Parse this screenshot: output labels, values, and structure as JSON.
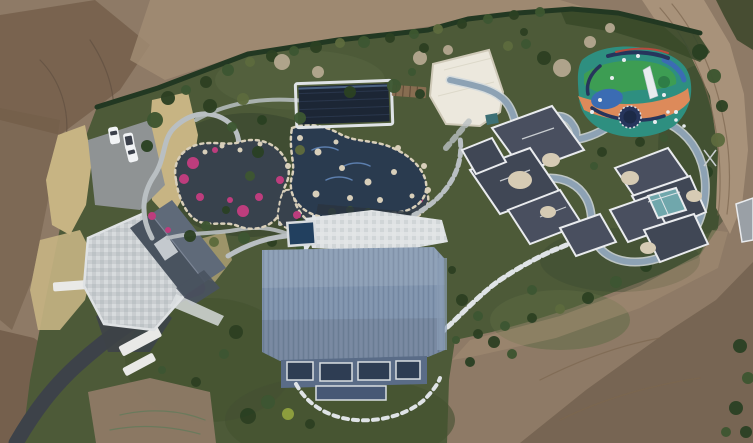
{
  "image": {
    "kind": "aerial-drone-photograph",
    "subject": "Top-down drone view of a private estate: landscaped ornamental garden with ponds and rockery pools, a dark louvred pool pavilion, a large steel-blue standing-seam roof house, two dark hip-roof villas with white parapets, a flat white pavilion, a colourful painted playground with trampoline and slide, a winding blue track, a parking pad with three white cars, an asphalt driveway, all surrounded by graded bare earth and a dirt road",
    "width_px": 753,
    "height_px": 443
  },
  "palette": {
    "dirt_base": "#8e7a66",
    "dirt_dark": "#715d4a",
    "dirt_light": "#a38d74",
    "dirt_shadow": "#5f4f3e",
    "road_dirt": "#a8927a",
    "rut": "#7c6750",
    "scrub_dark": "#474d31",
    "brush_dark": "#3a4a2b",
    "green_base": "#4d5a39",
    "lawn_dark": "#42502f",
    "lawn_light": "#5b6a42",
    "bed_dark": "#3a482c",
    "hedge": "#233720",
    "tree_dark": "#2c4124",
    "tree_mid": "#3d5630",
    "tree_olive": "#5d6b3d",
    "tree_pale": "#b3a78f",
    "tree_yellow": "#8fa03f",
    "reed": "#c7b483",
    "water_pond": "#39424d",
    "water_pool": "#2c3a50",
    "wave_blue": "#5b7fae",
    "rock_cream": "#d8cfba",
    "flower_pink": "#bd3c7d",
    "path_light": "#b9bfc2",
    "paver_white": "#dfe3e6",
    "track": "#8da2b4",
    "track_edge": "#d2d9dd",
    "pavilion": "#1e2836",
    "pergola": "#8a6f52",
    "white_roof": "#ece8dd",
    "white_roof_edge": "#cfc9b8",
    "equip_teal": "#3e6f74",
    "roof_main": "#7e92ac",
    "roof_side": "#8b9eb6",
    "facade": "#5a6c87",
    "window_dark": "#2e3c52",
    "glass_low": "#465974",
    "frame_white": "#d9dee2",
    "roof_villa": "#49505e",
    "roof_villa_dark": "#3f4654",
    "roof_trim": "#e9ebee",
    "roof_cream": "#d6cbb4",
    "glass_teal": "#6fa7ac",
    "roof_left": "#49525f",
    "roof_left_light": "#5f6a79",
    "terrace": "#c9cdd0",
    "terrace_light": "#dfe2e4",
    "shadow_band": "#2c3640",
    "asphalt": "#3e4348",
    "parking": "#8f9394",
    "car_white": "#f1f3f5",
    "car_glass": "#3a414b",
    "wall_white": "#e9e9e7",
    "spa_water": "#24405e",
    "play_teal": "#2e8f80",
    "play_green": "#3f9e4f",
    "play_orange": "#dd8a5a",
    "play_blue": "#3b6cb3",
    "play_navy": "#27355c",
    "play_red": "#b84a3c",
    "play_dome": "#2e7d46",
    "slide_white": "#e8ecef",
    "small_roof": "#9aa0a6",
    "pylon": "#c9cdd0",
    "streak_green": "#5e7a58"
  },
  "features": [
    {
      "id": "bare-earth",
      "label": "Graded bare earth surrounding the estate"
    },
    {
      "id": "dirt-road",
      "label": "Dirt track along the north-east boundary"
    },
    {
      "id": "hedge-boundary",
      "label": "Clipped hedge along the estate boundary"
    },
    {
      "id": "parking-area",
      "label": "Parking pad with three white cars"
    },
    {
      "id": "driveway",
      "label": "Curved asphalt driveway"
    },
    {
      "id": "left-house",
      "label": "House with slate gable roof and mosaic stone terrace"
    },
    {
      "id": "ornamental-garden",
      "label": "Ornamental garden with dark ponds, white stone paths and pink flower beds"
    },
    {
      "id": "pool-pavilion",
      "label": "Dark louvred pool pavilion"
    },
    {
      "id": "rock-pool",
      "label": "Naturalistic rock-edged swimming pool"
    },
    {
      "id": "white-pavilion",
      "label": "Flat white-roofed pavilion"
    },
    {
      "id": "spa-pool",
      "label": "Small rectangular spa pool on white terrace"
    },
    {
      "id": "main-house",
      "label": "Main house with steel-blue standing-seam roof and glass facade"
    },
    {
      "id": "villa-center",
      "label": "Central villa with dark hip roofs and white parapets"
    },
    {
      "id": "villa-east",
      "label": "East villa with central glass courtyard"
    },
    {
      "id": "playground",
      "label": "Painted playground with trampoline, slide and play equipment"
    },
    {
      "id": "running-track",
      "label": "Winding blue running track"
    },
    {
      "id": "lawns-trees",
      "label": "Lawns, reed grass and mature shrubs"
    }
  ],
  "scatter": {
    "trees": [
      [
        168,
        98,
        7,
        "tree_dark"
      ],
      [
        186,
        90,
        5,
        "tree_mid"
      ],
      [
        206,
        82,
        6,
        "tree_dark"
      ],
      [
        228,
        70,
        6,
        "tree_mid"
      ],
      [
        250,
        62,
        5,
        "tree_olive"
      ],
      [
        272,
        56,
        6,
        "tree_dark"
      ],
      [
        294,
        51,
        5,
        "tree_mid"
      ],
      [
        316,
        47,
        6,
        "tree_dark"
      ],
      [
        340,
        43,
        5,
        "tree_olive"
      ],
      [
        364,
        42,
        6,
        "tree_mid"
      ],
      [
        390,
        38,
        5,
        "tree_dark"
      ],
      [
        414,
        34,
        5,
        "tree_mid"
      ],
      [
        438,
        29,
        5,
        "tree_olive"
      ],
      [
        462,
        24,
        5,
        "tree_dark"
      ],
      [
        488,
        19,
        5,
        "tree_mid"
      ],
      [
        514,
        15,
        5,
        "tree_dark"
      ],
      [
        540,
        12,
        5,
        "tree_mid"
      ],
      [
        282,
        62,
        8,
        "tree_pale"
      ],
      [
        318,
        72,
        6,
        "tree_pale"
      ],
      [
        420,
        58,
        7,
        "tree_pale"
      ],
      [
        448,
        50,
        5,
        "tree_pale"
      ],
      [
        562,
        68,
        9,
        "tree_pale"
      ],
      [
        590,
        42,
        6,
        "tree_pale"
      ],
      [
        610,
        28,
        5,
        "tree_pale"
      ],
      [
        155,
        120,
        8,
        "tree_mid"
      ],
      [
        147,
        146,
        6,
        "tree_dark"
      ],
      [
        210,
        106,
        7,
        "tree_dark"
      ],
      [
        243,
        99,
        6,
        "tree_olive"
      ],
      [
        232,
        127,
        5,
        "tree_mid"
      ],
      [
        262,
        120,
        5,
        "tree_dark"
      ],
      [
        300,
        118,
        6,
        "tree_mid"
      ],
      [
        350,
        92,
        6,
        "tree_dark"
      ],
      [
        394,
        86,
        7,
        "tree_mid"
      ],
      [
        420,
        94,
        5,
        "tree_dark"
      ],
      [
        258,
        152,
        6,
        "tree_dark"
      ],
      [
        250,
        176,
        5,
        "tree_mid"
      ],
      [
        300,
        150,
        5,
        "tree_olive"
      ],
      [
        190,
        236,
        6,
        "tree_dark"
      ],
      [
        214,
        242,
        5,
        "tree_olive"
      ],
      [
        244,
        238,
        6,
        "tree_mid"
      ],
      [
        272,
        242,
        5,
        "tree_dark"
      ],
      [
        300,
        248,
        4,
        "tree_mid"
      ],
      [
        424,
        48,
        5,
        "tree_dark"
      ],
      [
        412,
        72,
        4,
        "tree_mid"
      ],
      [
        508,
        46,
        5,
        "tree_olive"
      ],
      [
        524,
        32,
        4,
        "tree_dark"
      ],
      [
        602,
        152,
        5,
        "tree_dark"
      ],
      [
        594,
        166,
        4,
        "tree_mid"
      ],
      [
        576,
        132,
        4,
        "tree_dark"
      ],
      [
        640,
        142,
        5,
        "tree_dark"
      ],
      [
        664,
        138,
        4,
        "tree_mid"
      ],
      [
        544,
        58,
        7,
        "tree_dark"
      ],
      [
        526,
        44,
        5,
        "tree_mid"
      ],
      [
        700,
        52,
        8,
        "tree_dark"
      ],
      [
        714,
        76,
        7,
        "tree_mid"
      ],
      [
        722,
        106,
        6,
        "tree_dark"
      ],
      [
        718,
        140,
        7,
        "tree_olive"
      ],
      [
        707,
        172,
        6,
        "tree_dark"
      ],
      [
        695,
        200,
        6,
        "tree_mid"
      ],
      [
        688,
        228,
        6,
        "tree_dark"
      ],
      [
        670,
        252,
        5,
        "tree_mid"
      ],
      [
        646,
        266,
        6,
        "tree_dark"
      ],
      [
        616,
        282,
        6,
        "tree_mid"
      ],
      [
        588,
        298,
        6,
        "tree_dark"
      ],
      [
        560,
        309,
        5,
        "tree_olive"
      ],
      [
        532,
        318,
        5,
        "tree_dark"
      ],
      [
        505,
        326,
        5,
        "tree_mid"
      ],
      [
        478,
        334,
        5,
        "tree_dark"
      ],
      [
        456,
        340,
        4,
        "tree_mid"
      ],
      [
        462,
        300,
        6,
        "tree_dark"
      ],
      [
        478,
        316,
        5,
        "tree_mid"
      ],
      [
        494,
        342,
        6,
        "tree_dark"
      ],
      [
        512,
        354,
        5,
        "tree_mid"
      ],
      [
        470,
        362,
        5,
        "tree_dark"
      ],
      [
        532,
        290,
        5,
        "tree_mid"
      ],
      [
        452,
        270,
        4,
        "tree_dark"
      ],
      [
        236,
        332,
        7,
        "tree_dark"
      ],
      [
        224,
        354,
        5,
        "tree_mid"
      ],
      [
        248,
        416,
        8,
        "tree_dark"
      ],
      [
        268,
        402,
        7,
        "tree_mid"
      ],
      [
        288,
        414,
        6,
        "tree_yellow"
      ],
      [
        196,
        382,
        5,
        "tree_dark"
      ],
      [
        162,
        370,
        4,
        "tree_mid"
      ],
      [
        310,
        424,
        5,
        "tree_dark"
      ],
      [
        740,
        346,
        7,
        "tree_dark"
      ],
      [
        748,
        378,
        6,
        "tree_mid"
      ],
      [
        736,
        408,
        7,
        "tree_dark"
      ],
      [
        746,
        432,
        6,
        "tree_dark"
      ],
      [
        726,
        432,
        5,
        "tree_mid"
      ],
      [
        206,
        226,
        5,
        "tree_mid"
      ],
      [
        226,
        210,
        4,
        "tree_dark"
      ],
      [
        332,
        212,
        4,
        "tree_mid"
      ],
      [
        350,
        210,
        4,
        "tree_mid"
      ],
      [
        368,
        212,
        4,
        "tree_mid"
      ],
      [
        300,
        222,
        4,
        "tree_dark"
      ]
    ],
    "flowers": [
      [
        193,
        163,
        6
      ],
      [
        184,
        179,
        5
      ],
      [
        200,
        197,
        4
      ],
      [
        215,
        150,
        3
      ],
      [
        243,
        211,
        6
      ],
      [
        259,
        197,
        4
      ],
      [
        280,
        180,
        4
      ],
      [
        297,
        215,
        4
      ],
      [
        152,
        216,
        4
      ],
      [
        168,
        230,
        3
      ],
      [
        310,
        228,
        3
      ],
      [
        398,
        208,
        5
      ],
      [
        412,
        222,
        4
      ],
      [
        390,
        226,
        4
      ],
      [
        230,
        200,
        3
      ],
      [
        420,
        200,
        3
      ]
    ],
    "rocks": [
      [
        300,
        138,
        3
      ],
      [
        318,
        152,
        3.5
      ],
      [
        342,
        168,
        3
      ],
      [
        368,
        182,
        3.5
      ],
      [
        394,
        172,
        3
      ],
      [
        350,
        198,
        3
      ],
      [
        316,
        194,
        3.5
      ],
      [
        398,
        148,
        3
      ],
      [
        424,
        166,
        3
      ],
      [
        428,
        190,
        3
      ],
      [
        288,
        166,
        3
      ],
      [
        260,
        144,
        2.5
      ],
      [
        240,
        150,
        2.5
      ],
      [
        222,
        146,
        2.5
      ],
      [
        205,
        152,
        2.5
      ],
      [
        336,
        142,
        2.5
      ],
      [
        380,
        200,
        3
      ],
      [
        412,
        196,
        2.5
      ]
    ],
    "play_dots": [
      [
        600,
        100,
        2
      ],
      [
        612,
        78,
        2
      ],
      [
        648,
        70,
        2
      ],
      [
        664,
        95,
        2
      ],
      [
        676,
        112,
        2
      ],
      [
        592,
        112,
        2
      ],
      [
        655,
        122,
        2
      ],
      [
        668,
        112,
        1.8
      ],
      [
        676,
        120,
        1.8
      ],
      [
        684,
        126,
        1.8
      ],
      [
        624,
        60,
        2
      ],
      [
        638,
        56,
        2
      ]
    ]
  }
}
